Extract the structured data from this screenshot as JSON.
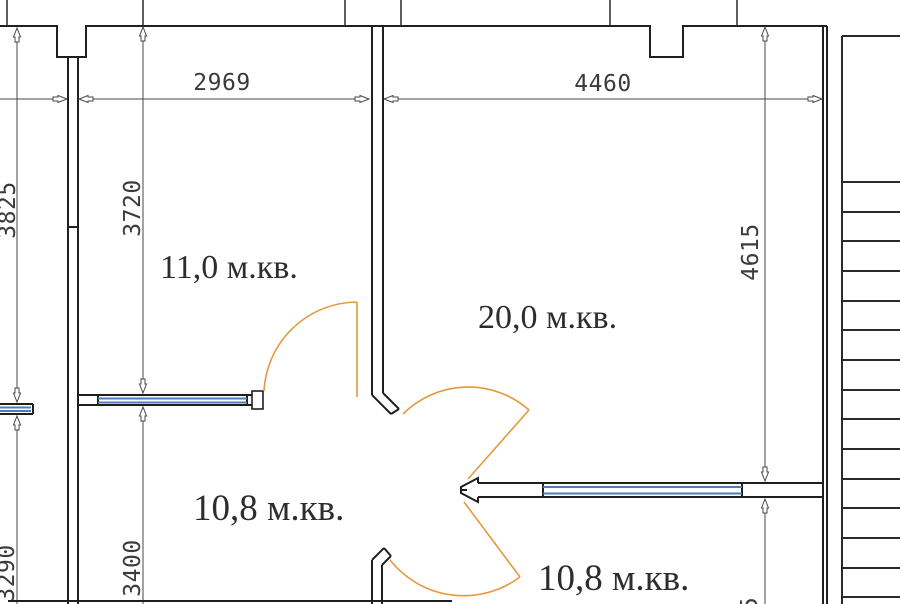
{
  "drawing": {
    "kind": "apartment floor plan",
    "rooms": [
      {
        "label": "11,0 м.кв."
      },
      {
        "label": "20,0 м.кв."
      },
      {
        "label": "10,8 м.кв."
      },
      {
        "label": "10,8 м.кв."
      }
    ],
    "dims": {
      "top_left": {
        "value": "2969",
        "orientation": "horizontal"
      },
      "top_right": {
        "value": "4460",
        "orientation": "horizontal"
      },
      "room11_height": {
        "value": "3720",
        "orientation": "vertical"
      },
      "room20_height": {
        "value": "4615",
        "orientation": "vertical"
      },
      "room108_height": {
        "value": "3400",
        "orientation": "vertical"
      },
      "edge_top": {
        "value": "3825",
        "orientation": "vertical",
        "partial": true
      },
      "edge_bottom": {
        "value": "3290",
        "orientation": "vertical",
        "partial": true
      },
      "bottom_right_partial": {
        "value": "5",
        "orientation": "vertical",
        "partial": true
      }
    },
    "features": {
      "door_swings": 3,
      "windows": 3,
      "stair_treads": 15
    },
    "colors": {
      "walls": "#1f1f1f",
      "doors": "#e29a3f",
      "windows": "#4d7cb8",
      "dimensions": "#3b3b3b",
      "background": "#ffffff"
    }
  }
}
